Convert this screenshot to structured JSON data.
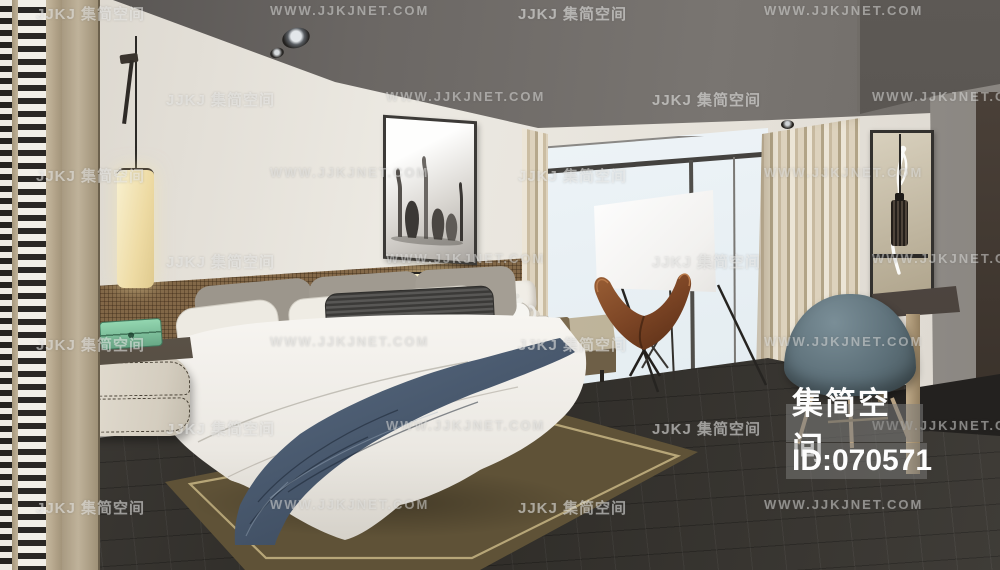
{
  "meta": {
    "canvas": {
      "width": 1000,
      "height": 570
    },
    "description": "3D interior render of a modern bedroom with bed, butterfly chair, projection screen, desk chair and floor-to-ceiling window"
  },
  "watermarks": {
    "brand_text": "JJKJ 集简空间",
    "site_text": "WWW.JJKJNET.COM",
    "rows": [
      {
        "y": 3,
        "items": [
          {
            "x": 36,
            "kind": "brand"
          },
          {
            "x": 270,
            "kind": "site"
          },
          {
            "x": 518,
            "kind": "brand"
          },
          {
            "x": 764,
            "kind": "site"
          }
        ]
      },
      {
        "y": 89,
        "items": [
          {
            "x": 166,
            "kind": "brand"
          },
          {
            "x": 386,
            "kind": "site"
          },
          {
            "x": 652,
            "kind": "brand"
          },
          {
            "x": 872,
            "kind": "site"
          }
        ]
      },
      {
        "y": 165,
        "items": [
          {
            "x": 36,
            "kind": "brand"
          },
          {
            "x": 270,
            "kind": "site"
          },
          {
            "x": 518,
            "kind": "brand"
          },
          {
            "x": 764,
            "kind": "site"
          }
        ]
      },
      {
        "y": 251,
        "items": [
          {
            "x": 166,
            "kind": "brand"
          },
          {
            "x": 386,
            "kind": "site"
          },
          {
            "x": 652,
            "kind": "brand"
          },
          {
            "x": 872,
            "kind": "site"
          }
        ]
      },
      {
        "y": 334,
        "items": [
          {
            "x": 36,
            "kind": "brand"
          },
          {
            "x": 270,
            "kind": "site"
          },
          {
            "x": 518,
            "kind": "brand"
          },
          {
            "x": 764,
            "kind": "site"
          }
        ]
      },
      {
        "y": 418,
        "items": [
          {
            "x": 166,
            "kind": "brand"
          },
          {
            "x": 386,
            "kind": "site"
          },
          {
            "x": 652,
            "kind": "brand"
          },
          {
            "x": 872,
            "kind": "site"
          }
        ]
      },
      {
        "y": 497,
        "items": [
          {
            "x": 36,
            "kind": "brand"
          },
          {
            "x": 270,
            "kind": "site"
          },
          {
            "x": 518,
            "kind": "brand"
          },
          {
            "x": 764,
            "kind": "site"
          }
        ]
      }
    ]
  },
  "badge": {
    "brand": "集简空间",
    "id_label": "ID:070571"
  },
  "palette": {
    "ceiling": "#6b6764",
    "wall_cream": "#e9e6de",
    "headboard_rattan": "#8a6e4c",
    "floor_dark": "#37342f",
    "rug_olive": "#55492f",
    "rug_border": "#c7b584",
    "throw_blue": "#4e6078",
    "leather_chair": "#8a5330",
    "desk_chair_teal": "#5d7078",
    "lamp_glow": "#f2e7bd",
    "glass_blue": "#e9f0f4",
    "green_box": "#7cc09c"
  }
}
